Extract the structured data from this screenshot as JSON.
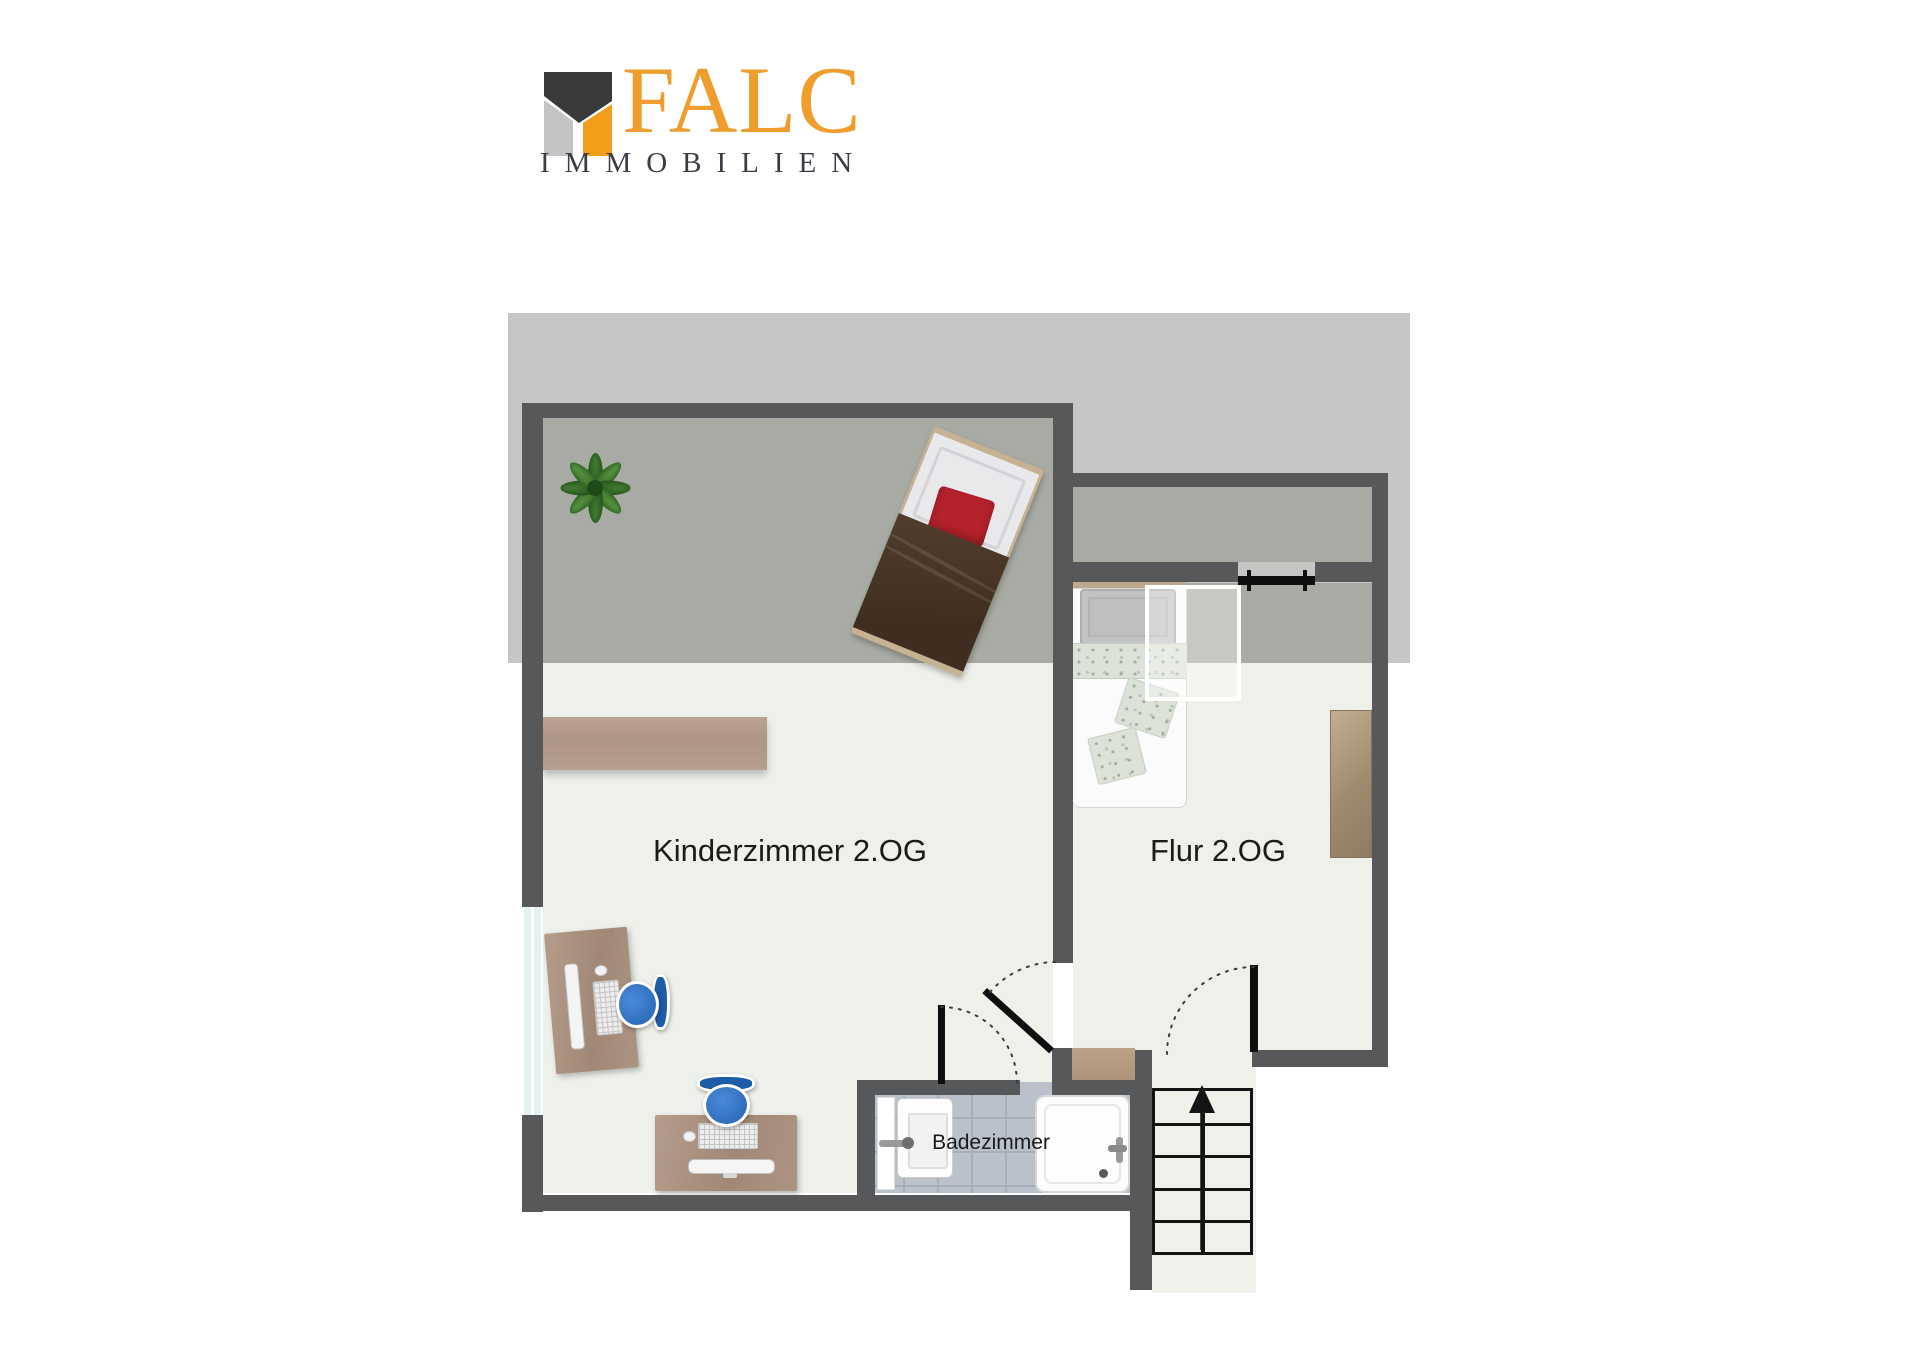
{
  "logo": {
    "brand": "FALC",
    "subtitle": "IMMOBILIEN",
    "brand_color": "#EF9D2C",
    "mark_dark": "#3A3A3C",
    "mark_gray": "#C2C3C5",
    "mark_orange": "#F19D1A",
    "subtitle_color": "#3C3C46"
  },
  "floorplan": {
    "rooms": [
      {
        "id": "kinderzimmer",
        "label": "Kinderzimmer 2.OG"
      },
      {
        "id": "flur",
        "label": "Flur 2.OG"
      },
      {
        "id": "badezimmer",
        "label": "Badezimmer"
      }
    ],
    "features": [
      "roof-slope-overlay",
      "skylight-window",
      "staircase-up",
      "bathroom-shower",
      "bathroom-sink"
    ],
    "colors": {
      "wall": "#56585A",
      "floor": "#EEF0EA",
      "floor_under_roof": "#A8ABA3",
      "roof_overlay": "#C6C7C5",
      "bathroom_tile": "#BAC1CA",
      "wood": "#B29A89",
      "door": "#0F0F0F",
      "chair_blue": "#2F72C4",
      "bed_brown": "#46332​5",
      "pillow_red": "#B3212B",
      "plant_green": "#3A7A2B"
    }
  }
}
